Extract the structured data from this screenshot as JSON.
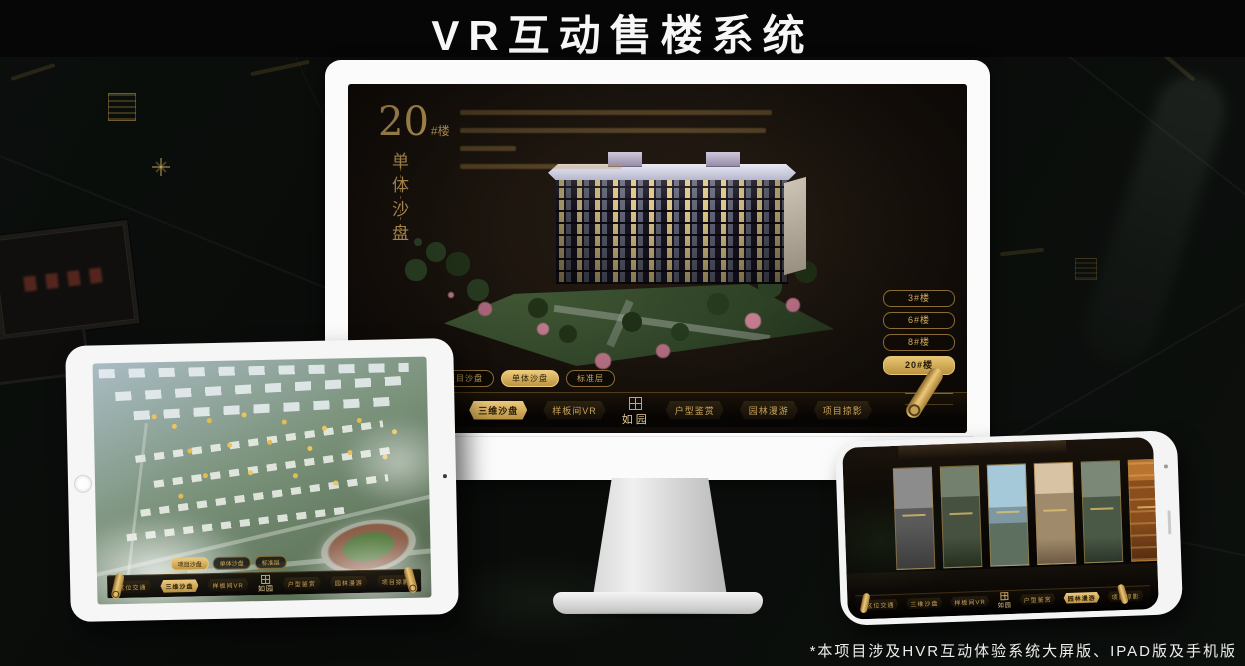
{
  "page": {
    "title": "VR互动售楼系统",
    "footnote": "*本项目涉及HVR互动体验系统大屏版、IPAD版及手机版"
  },
  "colors": {
    "accent_gold": "#c8a24e",
    "gold_bright": "#ecca7e",
    "screen_bg": "#1a130d",
    "nav_bg": "#0c0906"
  },
  "icons": {
    "scroll_handle": "gold-scroll-roll",
    "logo_seal": "seal-square",
    "compass": "four-point-star"
  },
  "nav": {
    "tabs": [
      "项目沙盘",
      "单体沙盘",
      "标准层"
    ],
    "menu_left": [
      "区位交通",
      "三维沙盘",
      "样板间VR"
    ],
    "logo": "如园",
    "menu_right": [
      "户型鉴赏",
      "园林漫游",
      "项目掠影"
    ]
  },
  "monitor": {
    "heading_number": "20",
    "heading_unit": "#楼",
    "heading_title": "单体沙盘",
    "building_buttons": [
      "3#楼",
      "6#楼",
      "8#楼",
      "20#楼"
    ],
    "active_building": "20#楼",
    "active_tab": "单体沙盘",
    "active_menu": "三维沙盘"
  },
  "tablet": {
    "active_tab": "项目沙盘",
    "active_menu": "三维沙盘"
  },
  "phone": {
    "active_menu": "园林漫游"
  }
}
